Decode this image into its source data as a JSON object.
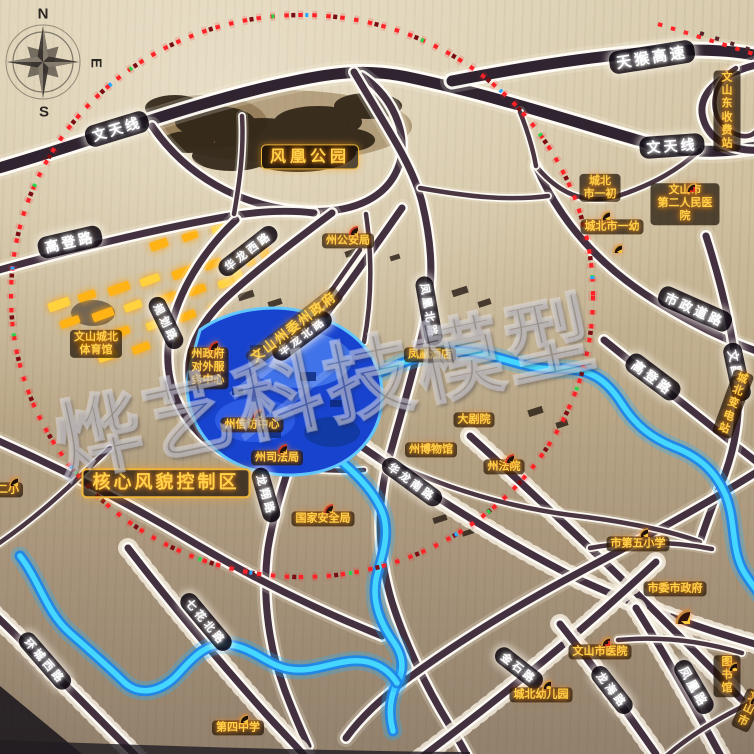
{
  "compass": {
    "n": "N",
    "s": "S",
    "e": "E"
  },
  "watermark": {
    "text": "烨艺科技模型"
  },
  "colors": {
    "board": "#c9b896",
    "road_core": "#43313f",
    "road_edge": "#fffdf8",
    "river": "#3fd2ff",
    "lake": "#1743cf",
    "label_yellow": "#ffd24a",
    "boundary_dots": "#ff2328",
    "building_glow": "#ffb315"
  },
  "road_labels": [
    {
      "id": "wentianxian-w",
      "text": "文天线",
      "x": 117,
      "y": 129,
      "rot": -17,
      "size": 14
    },
    {
      "id": "tianhou-gaosu",
      "text": "天猴高速",
      "x": 652,
      "y": 57,
      "rot": -9,
      "size": 15
    },
    {
      "id": "wentianxian-e",
      "text": "文天线",
      "x": 672,
      "y": 146,
      "rot": -4,
      "size": 14
    },
    {
      "id": "gaodeng-lu-w",
      "text": "高登路",
      "x": 70,
      "y": 242,
      "rot": -13,
      "size": 14
    },
    {
      "id": "guihua-lu",
      "text": "规划路",
      "x": 166,
      "y": 323,
      "rot": 64,
      "size": 11
    },
    {
      "id": "hualong-xilu",
      "text": "华龙西路",
      "x": 248,
      "y": 251,
      "rot": -38,
      "size": 11
    },
    {
      "id": "hualong-beilu",
      "text": "华龙北路",
      "x": 302,
      "y": 336,
      "rot": -37,
      "size": 11
    },
    {
      "id": "fenghuang-beilu",
      "text": "凤凰北路",
      "x": 429,
      "y": 311,
      "rot": 80,
      "size": 11
    },
    {
      "id": "shizheng-daolu",
      "text": "市政道路",
      "x": 695,
      "y": 309,
      "rot": 24,
      "size": 13
    },
    {
      "id": "gaodeng-lu-e",
      "text": "高登路",
      "x": 653,
      "y": 377,
      "rot": 37,
      "size": 13
    },
    {
      "id": "wenchang-lu",
      "text": "文昌路",
      "x": 737,
      "y": 372,
      "rot": 78,
      "size": 12
    },
    {
      "id": "hualong-nanlu",
      "text": "华龙南路",
      "x": 412,
      "y": 482,
      "rot": 36,
      "size": 11
    },
    {
      "id": "longxiang-lu",
      "text": "龙翔路",
      "x": 266,
      "y": 495,
      "rot": 74,
      "size": 11
    },
    {
      "id": "qihua-beilu",
      "text": "七花北路",
      "x": 206,
      "y": 622,
      "rot": 50,
      "size": 11
    },
    {
      "id": "huancheng-xilu",
      "text": "环城西路",
      "x": 45,
      "y": 661,
      "rot": 49,
      "size": 11
    },
    {
      "id": "jinshi-lu",
      "text": "金石路",
      "x": 519,
      "y": 668,
      "rot": 38,
      "size": 11
    },
    {
      "id": "longhai-lu",
      "text": "龙海路",
      "x": 612,
      "y": 690,
      "rot": 52,
      "size": 11
    },
    {
      "id": "fenghuang-lu",
      "text": "凤凰路",
      "x": 694,
      "y": 687,
      "rot": 60,
      "size": 12
    }
  ],
  "place_labels": [
    {
      "id": "fenghuang-park",
      "text": "风凰公园",
      "x": 310,
      "y": 157,
      "cls": "boxed-park"
    },
    {
      "id": "wenshan-east-toll",
      "text": "文山东\n收费站",
      "x": 727,
      "y": 111
    },
    {
      "id": "chengbei-shiyichu",
      "text": "城北\n市一初",
      "x": 600,
      "y": 188,
      "icon": "school",
      "idy": 22
    },
    {
      "id": "chengbei-shiyiyou",
      "text": "城北市一幼",
      "x": 612,
      "y": 227,
      "icon": "school",
      "idy": 16
    },
    {
      "id": "no2-peoples-hospital",
      "text": "文山市\n第二人民医院",
      "x": 685,
      "y": 204,
      "icon": "cross",
      "idy": -22
    },
    {
      "id": "zhou-gonganju",
      "text": "州公安局",
      "x": 348,
      "y": 241,
      "icon": "star",
      "idy": -16
    },
    {
      "id": "wenshan-chengbei-gym",
      "text": "文山城北\n体育馆",
      "x": 96,
      "y": 344
    },
    {
      "id": "zhou-govt-service-center",
      "text": "州政府\n对外服\n务中心",
      "x": 208,
      "y": 368,
      "icon": "star",
      "idy": -28
    },
    {
      "id": "zhouwei-zhouzhengfu",
      "text": "文山州委州政府",
      "x": 294,
      "y": 327,
      "rot": -38,
      "cls": "glowtext"
    },
    {
      "id": "fenghuang-hotel",
      "text": "凤凰酒店",
      "x": 430,
      "y": 355
    },
    {
      "id": "zhou-xinfang-center",
      "text": "州信访中心",
      "x": 252,
      "y": 425,
      "icon": "star",
      "idy": -17
    },
    {
      "id": "zhou-sifaju",
      "text": "州司法局",
      "x": 277,
      "y": 458,
      "icon": "star",
      "idy": -15
    },
    {
      "id": "grand-theater",
      "text": "大剧院",
      "x": 474,
      "y": 420
    },
    {
      "id": "zhou-museum",
      "text": "州博物馆",
      "x": 431,
      "y": 450
    },
    {
      "id": "zhou-fayuan",
      "text": "州法院",
      "x": 504,
      "y": 467,
      "icon": "star",
      "idy": -14
    },
    {
      "id": "core-style-control-zone",
      "text": "核心风貌控制区",
      "x": 166,
      "y": 483,
      "cls": "boxed-core"
    },
    {
      "id": "guojia-anquanju",
      "text": "国家安全局",
      "x": 323,
      "y": 519,
      "icon": "star",
      "idy": -16
    },
    {
      "id": "no5-primary-school",
      "text": "市第五小学",
      "x": 638,
      "y": 544,
      "icon": "school",
      "idy": -17
    },
    {
      "id": "shiwei-shizhengfu",
      "text": "市委市政府",
      "x": 675,
      "y": 589,
      "icon": "bigstar",
      "idy": 20
    },
    {
      "id": "wenshan-hospital",
      "text": "文山市医院",
      "x": 600,
      "y": 652,
      "icon": "cross",
      "idy": -16
    },
    {
      "id": "library",
      "text": "图书馆",
      "x": 727,
      "y": 676,
      "icon": "book",
      "idy": -15
    },
    {
      "id": "chengbei-kindergarten",
      "text": "城北幼儿园",
      "x": 541,
      "y": 695,
      "icon": "book",
      "idy": -16
    },
    {
      "id": "no4-middle-school",
      "text": "第四中学",
      "x": 238,
      "y": 728,
      "icon": "school",
      "idy": -15
    },
    {
      "id": "erxiao",
      "text": "二小",
      "x": 8,
      "y": 490,
      "icon": "school",
      "idy": -14
    },
    {
      "id": "chengbei-substation",
      "text": "城北变电站",
      "x": 733,
      "y": 404,
      "rot": 20
    },
    {
      "id": "wenshan-city-corner",
      "text": "文山市",
      "x": 748,
      "y": 710,
      "icon": "school",
      "idy": -16,
      "rot": 25
    }
  ]
}
